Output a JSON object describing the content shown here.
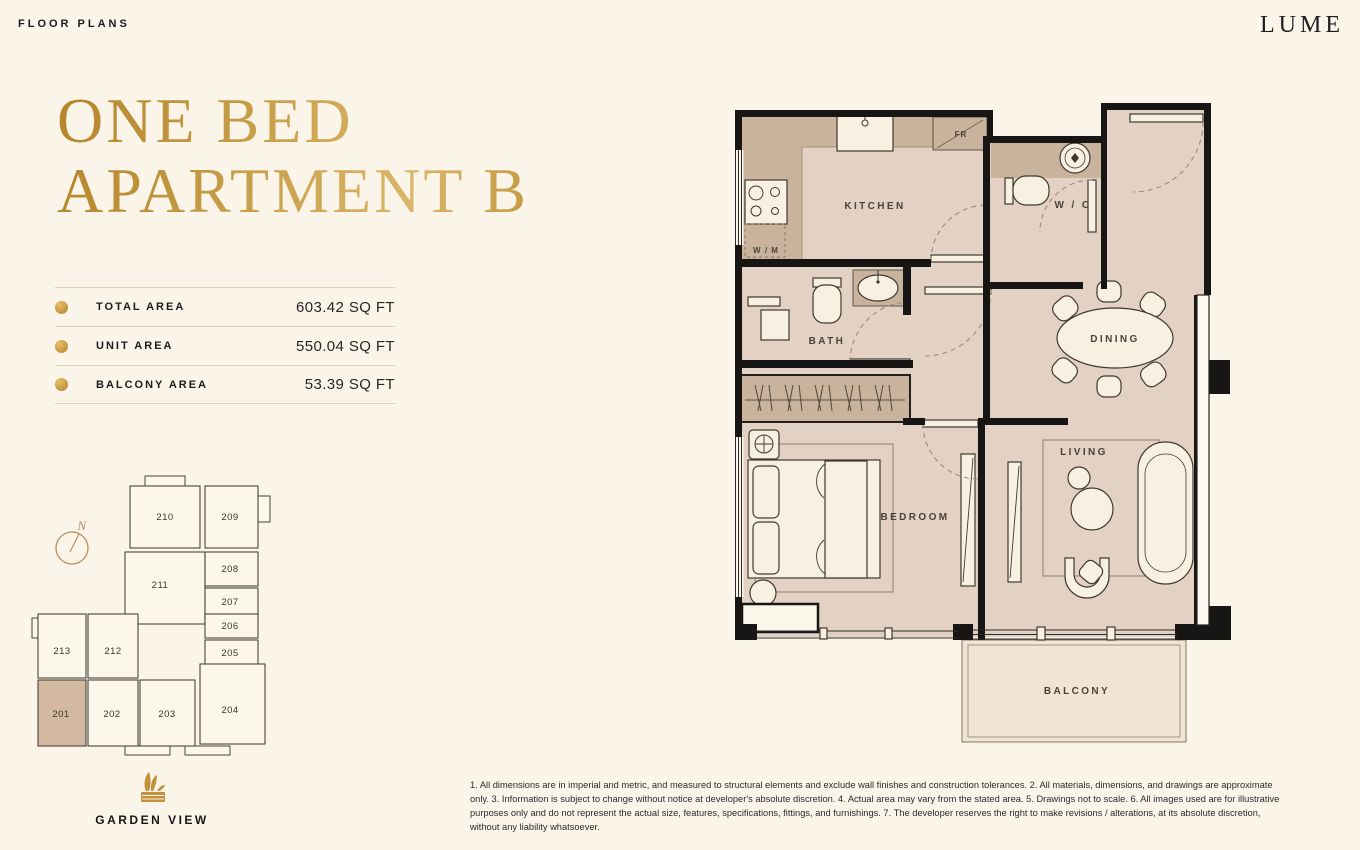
{
  "colors": {
    "page_bg": "#FAF5E8",
    "ink": "#1b1b1b",
    "gold": "#C49A44",
    "gold_light": "#DBB568",
    "gold_dark": "#B5852C",
    "floor": "#E3D2C4",
    "wet": "#C9B39D",
    "balcony_floor": "#F0E5D3",
    "wall": "#181614",
    "keyplan_highlight": "#D3B9A2",
    "compass": "#BD8B5E",
    "furniture": "#F8F1E2"
  },
  "header": {
    "eyebrow": "FLOOR PLANS",
    "brand": "LUME"
  },
  "title": {
    "line1": "ONE BED",
    "line2": "APARTMENT B"
  },
  "areas": {
    "rows": [
      {
        "label": "TOTAL AREA",
        "value": "603.42 SQ FT"
      },
      {
        "label": "UNIT AREA",
        "value": "550.04 SQ FT"
      },
      {
        "label": "BALCONY AREA",
        "value": "53.39 SQ FT"
      }
    ]
  },
  "keyplan": {
    "north_label": "N",
    "highlighted_unit": "201",
    "caption": "GARDEN VIEW",
    "units": [
      {
        "label": "210"
      },
      {
        "label": "209"
      },
      {
        "label": "211"
      },
      {
        "label": "208"
      },
      {
        "label": "207"
      },
      {
        "label": "206"
      },
      {
        "label": "205"
      },
      {
        "label": "204"
      },
      {
        "label": "213"
      },
      {
        "label": "212"
      },
      {
        "label": "201"
      },
      {
        "label": "202"
      },
      {
        "label": "203"
      }
    ]
  },
  "floorplan": {
    "rooms": {
      "kitchen": "KITCHEN",
      "wc": "W / C",
      "dining": "DINING",
      "bath": "BATH",
      "bedroom": "BEDROOM",
      "living": "LIVING",
      "balcony": "BALCONY"
    },
    "fixtures": {
      "washing_machine": "W / M",
      "fridge": "FR"
    }
  },
  "disclaimer": "1. All dimensions are in imperial and metric, and measured to structural elements and exclude wall finishes and construction tolerances. 2. All materials, dimensions, and drawings are approximate only. 3. Information is subject to change without notice at developer's absolute discretion. 4. Actual area may vary from the stated area. 5. Drawings not to scale. 6. All images used are for illustrative purposes only and do not represent the actual size, features, specifications, fittings, and furnishings. 7. The developer reserves the right to make revisions / alterations, at its absolute discretion, without any liability whatsoever."
}
